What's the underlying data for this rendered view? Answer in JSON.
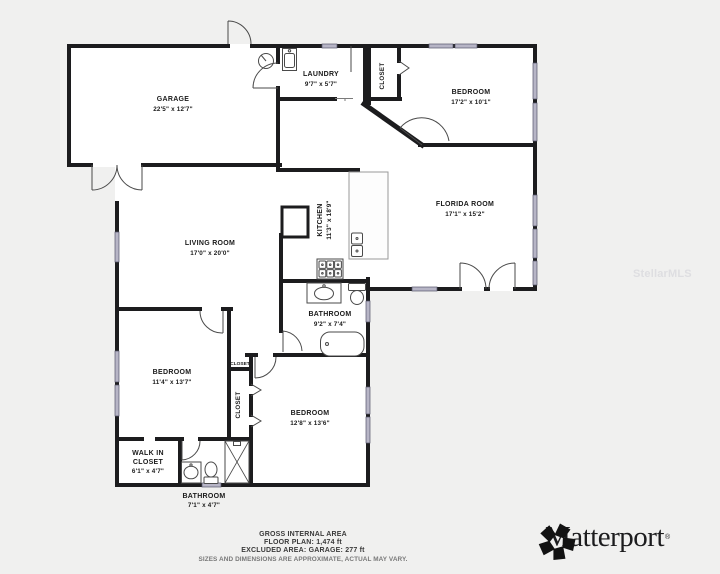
{
  "watermark": "StellarMLS",
  "rooms": {
    "garage": {
      "name": "GARAGE",
      "dims": "22'5\" x 12'7\""
    },
    "laundry": {
      "name": "LAUNDRY",
      "dims": "9'7\" x 5'7\""
    },
    "closet_ne": {
      "name": "CLOSET"
    },
    "bedroom_ne": {
      "name": "BEDROOM",
      "dims": "17'2\" x 10'1\""
    },
    "florida_room": {
      "name": "FLORIDA ROOM",
      "dims": "17'1\" x 15'2\""
    },
    "kitchen": {
      "name": "KITCHEN",
      "dims": "11'3\" x 18'9\""
    },
    "living_room": {
      "name": "LIVING ROOM",
      "dims": "17'0\" x 20'0\""
    },
    "bathroom_main": {
      "name": "BATHROOM",
      "dims": "9'2\" x 7'4\""
    },
    "bedroom_west": {
      "name": "BEDROOM",
      "dims": "11'4\" x 13'7\""
    },
    "closet_hall": {
      "name": "CLOSET"
    },
    "closet_long": {
      "name": "CLOSET"
    },
    "bedroom_south": {
      "name": "BEDROOM",
      "dims": "12'8\" x 13'6\""
    },
    "walk_in_closet": {
      "line1": "WALK IN",
      "line2": "CLOSET",
      "dims": "6'1\" x 4'7\""
    },
    "bathroom_south": {
      "name": "BATHROOM",
      "dims": "7'1\" x 4'7\""
    }
  },
  "footer": {
    "line1": "GROSS INTERNAL AREA",
    "line2": "FLOOR PLAN: 1,474 ft",
    "line3": "EXCLUDED AREA: GARAGE: 277 ft",
    "line4": "SIZES AND DIMENSIONS ARE APPROXIMATE, ACTUAL MAY VARY."
  },
  "brand": {
    "name": "Matterport",
    "registered": "®"
  },
  "colors": {
    "wall": "#1c1c1e",
    "window": "#b7b5c6",
    "floor": "#ffffff",
    "background": "#f0f0ef"
  }
}
